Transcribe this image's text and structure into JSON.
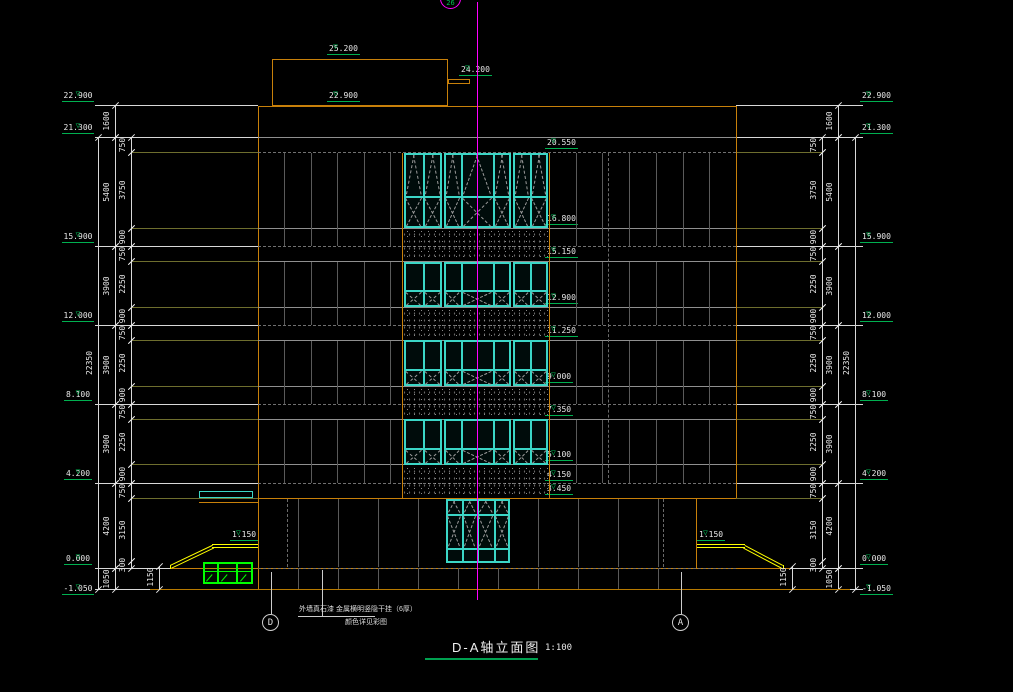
{
  "title": {
    "text": "D-A轴立面图",
    "scale": "1:100"
  },
  "axis": {
    "top": "26",
    "bottom_left": "D",
    "bottom_right": "A"
  },
  "annotation": {
    "line1": "外墙真石漆 金属横明竖隐干挂（6厚）",
    "line2": "颜色详见彩图"
  },
  "levels_outside": [
    {
      "label": "22.900",
      "m": 22.9
    },
    {
      "label": "21.300",
      "m": 21.3
    },
    {
      "label": "15.900",
      "m": 15.9
    },
    {
      "label": "12.000",
      "m": 12.0
    },
    {
      "label": "8.100",
      "m": 8.1
    },
    {
      "label": "4.200",
      "m": 4.2
    },
    {
      "label": "0.000",
      "m": 0.0
    },
    {
      "label": "-1.050",
      "m": -1.05
    }
  ],
  "levels_interior": [
    {
      "label": "20.550",
      "m": 20.55
    },
    {
      "label": "16.800",
      "m": 16.8
    },
    {
      "label": "15.150",
      "m": 15.15
    },
    {
      "label": "12.900",
      "m": 12.9
    },
    {
      "label": "11.250",
      "m": 11.25
    },
    {
      "label": "9.000",
      "m": 9.0
    },
    {
      "label": "7.350",
      "m": 7.35
    },
    {
      "label": "5.100",
      "m": 5.1
    },
    {
      "label": "4.150",
      "m": 4.15
    },
    {
      "label": "3.450",
      "m": 3.45
    }
  ],
  "levels_top": [
    {
      "label": "25.200",
      "m": 25.2,
      "x": 327
    },
    {
      "label": "24.200",
      "m": 24.2,
      "x": 459
    },
    {
      "label": "22.900",
      "m": 22.9,
      "x": 327
    }
  ],
  "ramp": {
    "level_label": "1.150",
    "height_dim": "1150"
  },
  "dim_chains": {
    "outer": [
      {
        "from": 21.3,
        "to": -1.05,
        "label": "22350"
      }
    ],
    "middle": [
      {
        "from": 22.9,
        "to": 21.3,
        "label": "1600"
      },
      {
        "from": 21.3,
        "to": 15.9,
        "label": "5400"
      },
      {
        "from": 15.9,
        "to": 12.0,
        "label": "3900"
      },
      {
        "from": 12.0,
        "to": 8.1,
        "label": "3900"
      },
      {
        "from": 8.1,
        "to": 4.2,
        "label": "3900"
      },
      {
        "from": 4.2,
        "to": 0.0,
        "label": "4200"
      },
      {
        "from": 0.0,
        "to": -1.05,
        "label": "1050"
      }
    ],
    "inner": [
      {
        "from": 21.3,
        "to": 20.55,
        "label": "750"
      },
      {
        "from": 20.55,
        "to": 16.8,
        "label": "3750"
      },
      {
        "from": 16.8,
        "to": 15.9,
        "label": "900"
      },
      {
        "from": 15.9,
        "to": 15.15,
        "label": "750"
      },
      {
        "from": 15.15,
        "to": 12.9,
        "label": "2250"
      },
      {
        "from": 12.9,
        "to": 12.0,
        "label": "900"
      },
      {
        "from": 12.0,
        "to": 11.25,
        "label": "750"
      },
      {
        "from": 11.25,
        "to": 9.0,
        "label": "2250"
      },
      {
        "from": 9.0,
        "to": 8.1,
        "label": "900"
      },
      {
        "from": 8.1,
        "to": 7.35,
        "label": "750"
      },
      {
        "from": 7.35,
        "to": 5.1,
        "label": "2250"
      },
      {
        "from": 5.1,
        "to": 4.2,
        "label": "900"
      },
      {
        "from": 4.2,
        "to": 3.45,
        "label": "750"
      },
      {
        "from": 3.45,
        "to": 0.3,
        "label": "3150"
      },
      {
        "from": 0.3,
        "to": 0.0,
        "label": "300"
      }
    ]
  },
  "colors": {
    "orange": "#c8800a",
    "teal": "#3bd6c6",
    "marker_green": "#00b050",
    "window_green": "#00ff00",
    "magenta": "#ff00ff",
    "yellow": "#ffff00",
    "grid_gray": "#5a5a5a",
    "dim_white": "#d8d8d8"
  }
}
